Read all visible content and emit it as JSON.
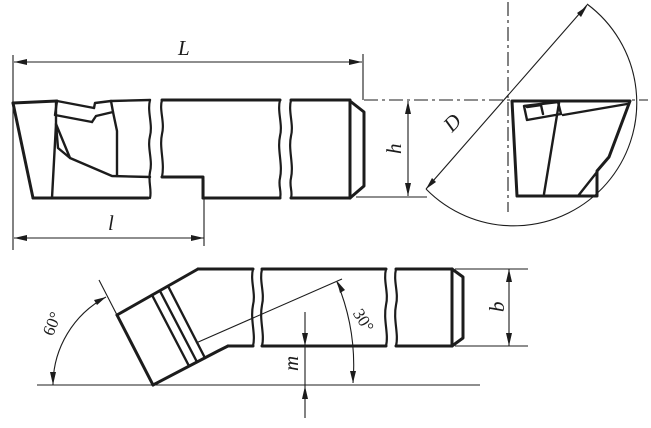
{
  "drawing": {
    "kind": "technical-drawing",
    "labels": {
      "overall_length": "L",
      "head_length": "l",
      "diameter": "D",
      "shank_height": "h",
      "shank_width": "b",
      "offset": "m",
      "head_angle": "60°",
      "tip_angle": "30°"
    },
    "colors": {
      "ink": "#1c1c1c",
      "paper": "#ffffff"
    }
  }
}
